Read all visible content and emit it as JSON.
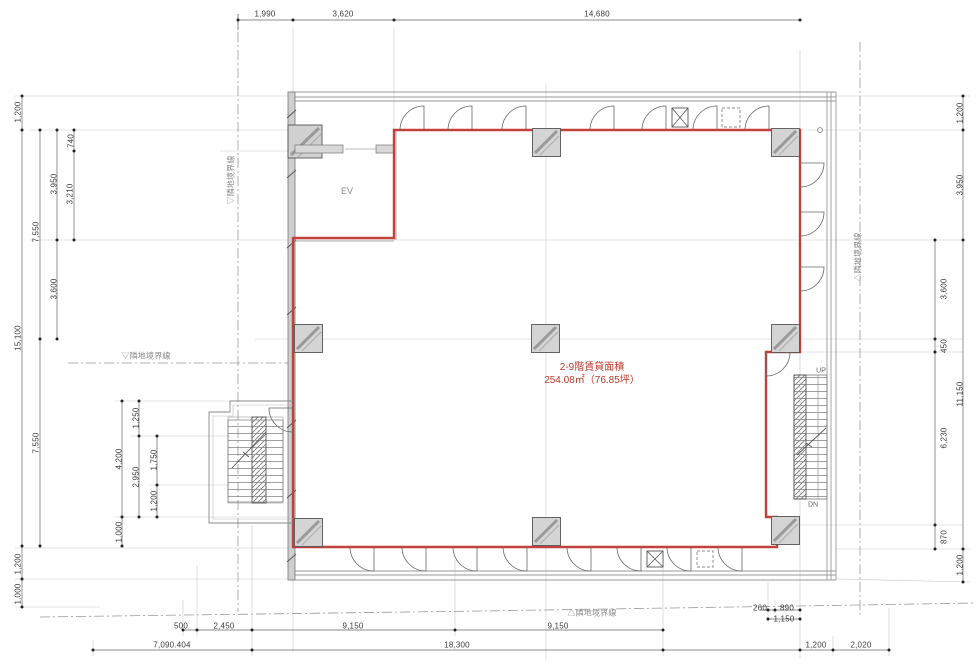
{
  "drawing": {
    "type": "architectural-floor-plan",
    "area_label": {
      "line1": "2-9階賃貸面積",
      "line2": "254.08㎡（76.85坪）"
    },
    "labels": {
      "elevator": "EV",
      "stairs_up": "UP",
      "stairs_down": "DN"
    },
    "colors": {
      "rental_boundary": "#c2423b",
      "wall_fill": "#d4d4d4",
      "line": "#666666",
      "area_text": "#c0392b"
    },
    "boundary_labels": [
      {
        "text": "▽隣地境界線",
        "x": 231,
        "y": 180,
        "rotate": true
      },
      {
        "text": "▽隣地境界線",
        "x": 146,
        "y": 356,
        "rotate": false
      },
      {
        "text": "△隣地境界線",
        "x": 858,
        "y": 257,
        "rotate": true
      },
      {
        "text": "△隣地境界線",
        "x": 592,
        "y": 613,
        "rotate": false
      }
    ],
    "dimensions": [
      {
        "text": "1,990",
        "x": 265,
        "y": 14,
        "rotate": false
      },
      {
        "text": "3,620",
        "x": 343,
        "y": 14,
        "rotate": false
      },
      {
        "text": "14,680",
        "x": 597,
        "y": 14,
        "rotate": false
      },
      {
        "text": "1,200",
        "x": 18,
        "y": 112,
        "rotate": true
      },
      {
        "text": "7,550",
        "x": 36,
        "y": 232,
        "rotate": true
      },
      {
        "text": "3,950",
        "x": 54,
        "y": 184,
        "rotate": true
      },
      {
        "text": "740",
        "x": 71,
        "y": 141,
        "rotate": true
      },
      {
        "text": "3,210",
        "x": 70,
        "y": 194,
        "rotate": true
      },
      {
        "text": "3,600",
        "x": 54,
        "y": 289,
        "rotate": true
      },
      {
        "text": "15,100",
        "x": 18,
        "y": 338,
        "rotate": true
      },
      {
        "text": "7,550",
        "x": 36,
        "y": 443,
        "rotate": true
      },
      {
        "text": "1,200",
        "x": 18,
        "y": 564,
        "rotate": true
      },
      {
        "text": "1,000",
        "x": 18,
        "y": 594,
        "rotate": true
      },
      {
        "text": "1,250",
        "x": 136,
        "y": 418,
        "rotate": true
      },
      {
        "text": "4,200",
        "x": 119,
        "y": 459,
        "rotate": true
      },
      {
        "text": "2,950",
        "x": 136,
        "y": 477,
        "rotate": true
      },
      {
        "text": "1,750",
        "x": 154,
        "y": 460,
        "rotate": true
      },
      {
        "text": "1,200",
        "x": 154,
        "y": 501,
        "rotate": true
      },
      {
        "text": "1,000",
        "x": 119,
        "y": 532,
        "rotate": true
      },
      {
        "text": "500",
        "x": 181,
        "y": 626,
        "rotate": false
      },
      {
        "text": "2,450",
        "x": 224,
        "y": 626,
        "rotate": false
      },
      {
        "text": "9,150",
        "x": 353,
        "y": 626,
        "rotate": false
      },
      {
        "text": "9,150",
        "x": 558,
        "y": 626,
        "rotate": false
      },
      {
        "text": "7,090.404",
        "x": 172,
        "y": 645,
        "rotate": false
      },
      {
        "text": "18,300",
        "x": 457,
        "y": 645,
        "rotate": false
      },
      {
        "text": "260",
        "x": 760,
        "y": 608,
        "rotate": false
      },
      {
        "text": "890",
        "x": 787,
        "y": 608,
        "rotate": false
      },
      {
        "text": "1,150",
        "x": 784,
        "y": 619,
        "rotate": false
      },
      {
        "text": "1,200",
        "x": 816,
        "y": 645,
        "rotate": false
      },
      {
        "text": "2,020",
        "x": 861,
        "y": 645,
        "rotate": false
      },
      {
        "text": "1,200",
        "x": 960,
        "y": 113,
        "rotate": true
      },
      {
        "text": "3,950",
        "x": 960,
        "y": 185,
        "rotate": true
      },
      {
        "text": "3,600",
        "x": 944,
        "y": 289,
        "rotate": true
      },
      {
        "text": "450",
        "x": 944,
        "y": 346,
        "rotate": true
      },
      {
        "text": "11,150",
        "x": 960,
        "y": 394,
        "rotate": true
      },
      {
        "text": "6,230",
        "x": 944,
        "y": 438,
        "rotate": true
      },
      {
        "text": "870",
        "x": 944,
        "y": 537,
        "rotate": true
      },
      {
        "text": "1,200",
        "x": 960,
        "y": 565,
        "rotate": true
      }
    ]
  }
}
